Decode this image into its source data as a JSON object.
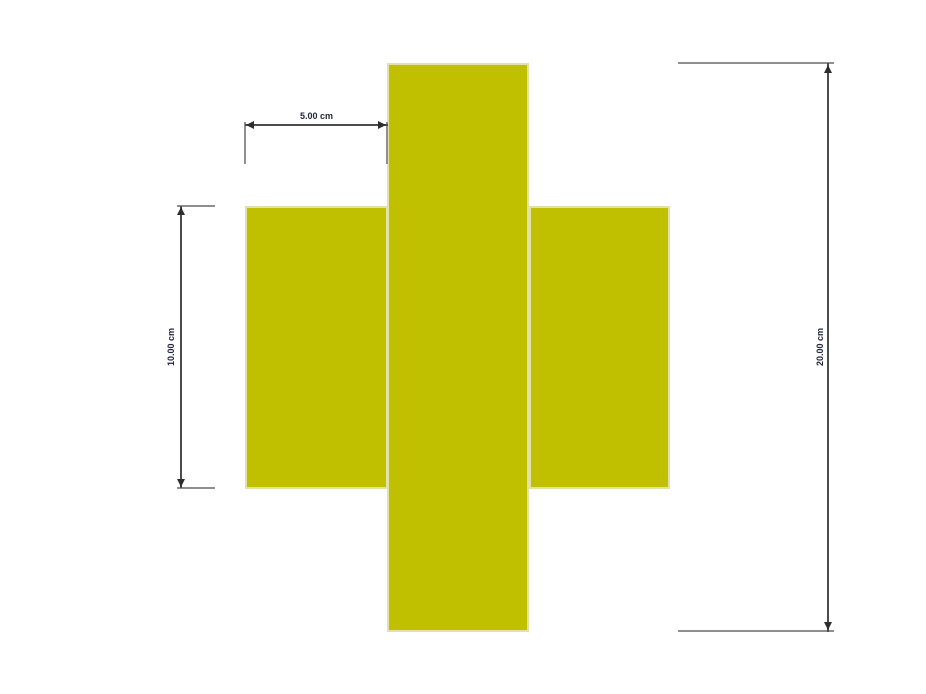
{
  "colors": {
    "background": "#ffffff",
    "shape_fill": "#c1c000",
    "shape_outline": "#e2e2a8",
    "extension_line": "#8f8f8f",
    "dimension_line": "#4c4c4c",
    "arrow": "#2d2d2d",
    "label_text": "#252540"
  },
  "shape": {
    "type": "cross"
  },
  "dimensions": [
    {
      "id": "top-width",
      "label": "5.00 cm",
      "value": 5.0,
      "unit": "cm",
      "orientation": "horizontal"
    },
    {
      "id": "left-height",
      "label": "10.00 cm",
      "value": 10.0,
      "unit": "cm",
      "orientation": "vertical"
    },
    {
      "id": "right-height",
      "label": "20.00 cm",
      "value": 20.0,
      "unit": "cm",
      "orientation": "vertical"
    }
  ]
}
